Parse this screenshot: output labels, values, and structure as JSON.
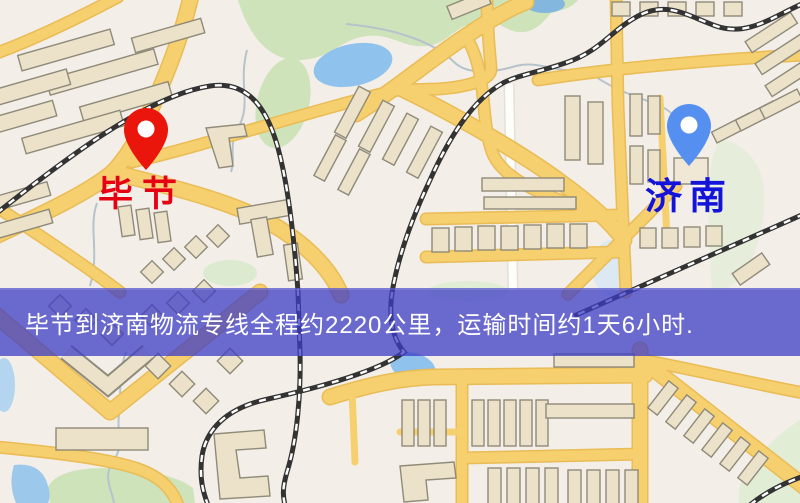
{
  "map": {
    "origin": {
      "label": "毕节"
    },
    "destination": {
      "label": "济南"
    },
    "banner": {
      "text": "毕节到济南物流专线全程约2220公里，运输时间约1天6小时."
    }
  },
  "colors": {
    "origin_pin": "#ea150b",
    "destination_pin": "#5590f0",
    "origin_label": "#e60012",
    "destination_label": "#1413d9",
    "banner_bg": "rgba(60,60,197,0.75)",
    "banner_text": "#ffffff",
    "road": "#f6cf6f",
    "road_edge": "#e9bc55",
    "railway": "#333333",
    "park": "#cfe3bb",
    "water": "#8fc2ec",
    "building": "#ebe2c9",
    "background": "#f3efe8"
  }
}
